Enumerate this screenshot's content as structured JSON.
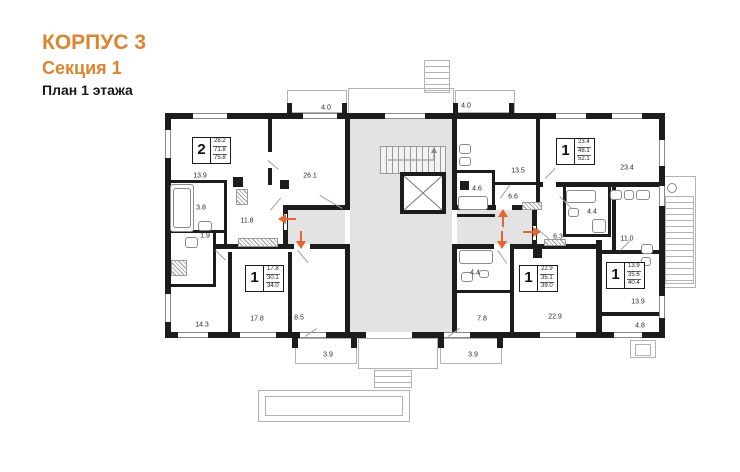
{
  "header": {
    "building": "КОРПУС 3",
    "section": "Секция 1",
    "floor_plan": "План 1 этажа"
  },
  "colors": {
    "accent_orange": "#E0832D",
    "entry_arrow_orange": "#E5652E",
    "wall_black": "#1C1C1C",
    "corridor_gray": "#E3E3E3",
    "outline_gray": "#B3B3B3"
  },
  "apartments": [
    {
      "rooms": "2",
      "living_area": "28.2",
      "area": "71.8",
      "total_area": "75.8"
    },
    {
      "rooms": "1",
      "living_area": "23.4",
      "area": "48.1",
      "total_area": "52.1"
    },
    {
      "rooms": "1",
      "living_area": "17.8",
      "area": "30.1",
      "total_area": "34.0"
    },
    {
      "rooms": "1",
      "living_area": "22.9",
      "area": "35.1",
      "total_area": "39.0"
    },
    {
      "rooms": "1",
      "living_area": "13.9",
      "area": "35.6",
      "total_area": "40.4"
    }
  ],
  "room_labels": [
    {
      "value": "4.0"
    },
    {
      "value": "4.0"
    },
    {
      "value": "13.9"
    },
    {
      "value": "26.1"
    },
    {
      "value": "3.8"
    },
    {
      "value": "11.8"
    },
    {
      "value": "1.9"
    },
    {
      "value": "14.3"
    },
    {
      "value": "17.8"
    },
    {
      "value": "8.5"
    },
    {
      "value": "3.9"
    },
    {
      "value": "4.6"
    },
    {
      "value": "13.5"
    },
    {
      "value": "6.6"
    },
    {
      "value": "4.4"
    },
    {
      "value": "23.4"
    },
    {
      "value": "6.3"
    },
    {
      "value": "11.0"
    },
    {
      "value": "4.4"
    },
    {
      "value": "7.8"
    },
    {
      "value": "22.9"
    },
    {
      "value": "3.9"
    },
    {
      "value": "13.9"
    },
    {
      "value": "4.8"
    }
  ],
  "entry_arrows": [
    {
      "direction": "left"
    },
    {
      "direction": "down"
    },
    {
      "direction": "up"
    },
    {
      "direction": "down"
    },
    {
      "direction": "right"
    }
  ]
}
